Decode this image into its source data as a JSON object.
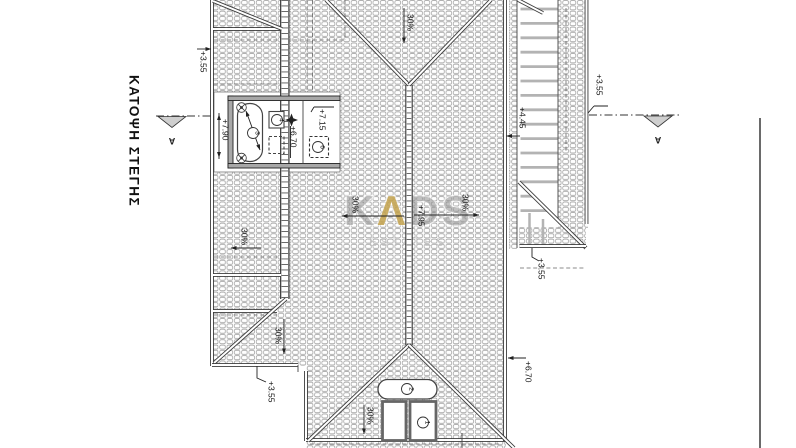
{
  "title": "ΚΑΤΟΨΗ ΣΤΕΓΗΣ",
  "watermark": {
    "k": "K",
    "a": "Λ",
    "d": "D",
    "s": "S",
    "subtitle": "ESTATES"
  },
  "section": {
    "left": "A",
    "right": "A"
  },
  "levels": {
    "top_left": "+3.55",
    "terrace_parapet": "+7.90",
    "terrace_mid": "+7.15",
    "terrace_light": "+6.70",
    "ridge": "+7.95",
    "pergola": "+4.45",
    "right_top": "+3.55",
    "right_mid": "+3.55",
    "bottom_left": "+3.55",
    "bottom_right": "+6.70"
  },
  "slope": {
    "label": "30%"
  },
  "callouts": {
    "n1": "1",
    "n2": "2",
    "n3": "3",
    "n4": "4",
    "n6": "6"
  },
  "colors": {
    "line": "#3c3c3c",
    "hatch": "#949494",
    "watermark_gray": "#8e8e8e",
    "watermark_accent": "#c2a14b",
    "triangle_fill": "#cfcfcf",
    "pergola_bar": "#b3b3b3"
  }
}
